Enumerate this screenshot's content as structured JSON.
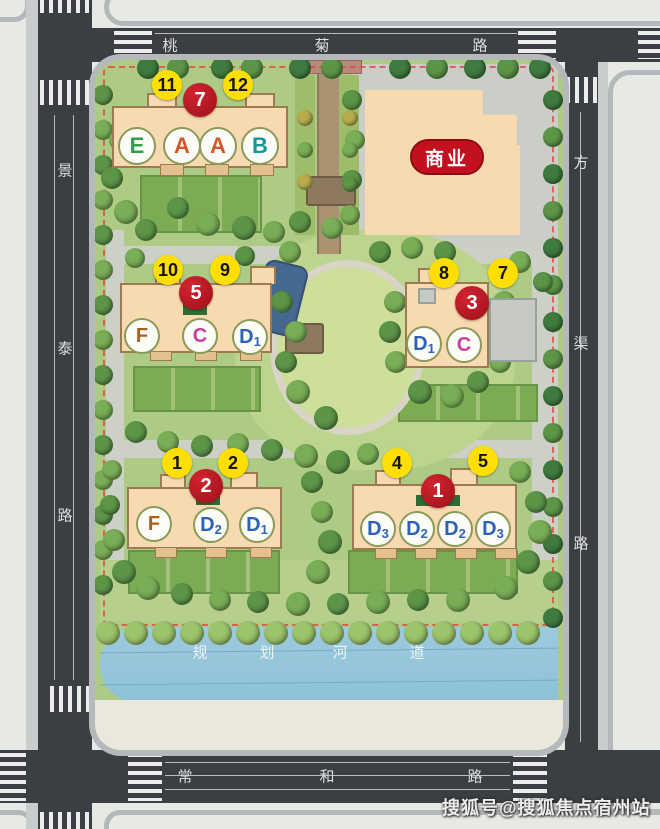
{
  "roads": {
    "top": {
      "name": "桃菊路",
      "chars": [
        "桃",
        "菊",
        "路"
      ]
    },
    "left": {
      "name": "景泰路",
      "chars": [
        "景",
        "泰",
        "路"
      ]
    },
    "right": {
      "name": "方渠路",
      "chars": [
        "方",
        "渠",
        "路"
      ]
    },
    "bottom": {
      "name": "常和路",
      "chars": [
        "常",
        "和",
        "路"
      ]
    }
  },
  "river": {
    "name": "规划河道",
    "chars": [
      "规",
      "划",
      "河",
      "道"
    ]
  },
  "commercial": {
    "label": "商业"
  },
  "buildings": [
    {
      "name": "north-residential",
      "red": "7",
      "yellows": [
        "11",
        "12"
      ],
      "units": [
        {
          "main": "E",
          "sub": ""
        },
        {
          "main": "A",
          "sub": ""
        },
        {
          "main": "A",
          "sub": ""
        },
        {
          "main": "B",
          "sub": ""
        }
      ]
    },
    {
      "name": "mid-west-residential",
      "red": "5",
      "yellows": [
        "10",
        "9"
      ],
      "units": [
        {
          "main": "F",
          "sub": ""
        },
        {
          "main": "C",
          "sub": ""
        },
        {
          "main": "D",
          "sub": "1"
        }
      ]
    },
    {
      "name": "mid-east-residential",
      "red": "3",
      "yellows": [
        "8",
        "7"
      ],
      "units": [
        {
          "main": "D",
          "sub": "1"
        },
        {
          "main": "C",
          "sub": ""
        }
      ]
    },
    {
      "name": "south-west-residential",
      "red": "2",
      "yellows": [
        "1",
        "2"
      ],
      "units": [
        {
          "main": "F",
          "sub": ""
        },
        {
          "main": "D",
          "sub": "2"
        },
        {
          "main": "D",
          "sub": "1"
        }
      ]
    },
    {
      "name": "south-east-residential",
      "red": "1",
      "yellows": [
        "4",
        "5"
      ],
      "units": [
        {
          "main": "D",
          "sub": "3"
        },
        {
          "main": "D",
          "sub": "2"
        },
        {
          "main": "D",
          "sub": "2"
        },
        {
          "main": "D",
          "sub": "3"
        }
      ]
    }
  ],
  "watermark": "搜狐号@搜狐焦点宿州站",
  "colors": {
    "marker_yellow": "#ffdf00",
    "marker_red": "#b5121e",
    "commercial_red": "#c2101f",
    "river_blue": "#92c4d8",
    "building_peach": "#f7dab0",
    "road_dark": "#3b3e42",
    "unit_E": "#2f9e4f",
    "unit_A": "#d4552a",
    "unit_B": "#15989a",
    "unit_F": "#a9611e",
    "unit_C": "#c73f9b",
    "unit_D": "#2e62b8"
  }
}
